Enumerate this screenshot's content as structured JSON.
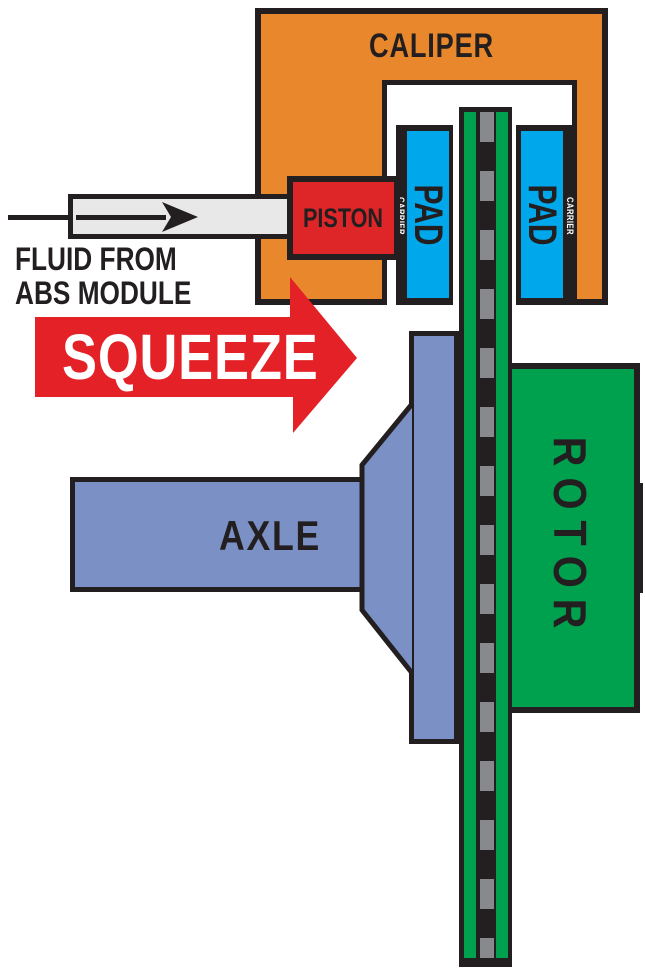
{
  "diagram": {
    "caliper": {
      "label": "CALIPER"
    },
    "piston": {
      "label": "PISTON"
    },
    "fluid_source": {
      "line1": "FLUID FROM",
      "line2": "ABS MODULE"
    },
    "squeeze": {
      "label": "SQUEEZE"
    },
    "pads": {
      "left": {
        "label": "PAD",
        "carrier_label": "CARRIER"
      },
      "right": {
        "label": "PAD",
        "carrier_label": "CARRIER"
      }
    },
    "rotor": {
      "label": "ROTOR"
    },
    "axle": {
      "label": "AXLE"
    }
  },
  "colors": {
    "ink": "#231F20",
    "caliper_orange": "#E8872B",
    "piston_red": "#DE2629",
    "squeeze_red": "#E32126",
    "pad_blue": "#00A7EA",
    "axle_blue": "#7B90C5",
    "rotor_green": "#00A14E",
    "tube_gray": "#E8E8E9",
    "dash_gray": "#87898C",
    "text_white": "#FFFFFF"
  },
  "icons": {
    "flow_arrow": "right-arrow",
    "squeeze_arrow": "right-arrow"
  }
}
